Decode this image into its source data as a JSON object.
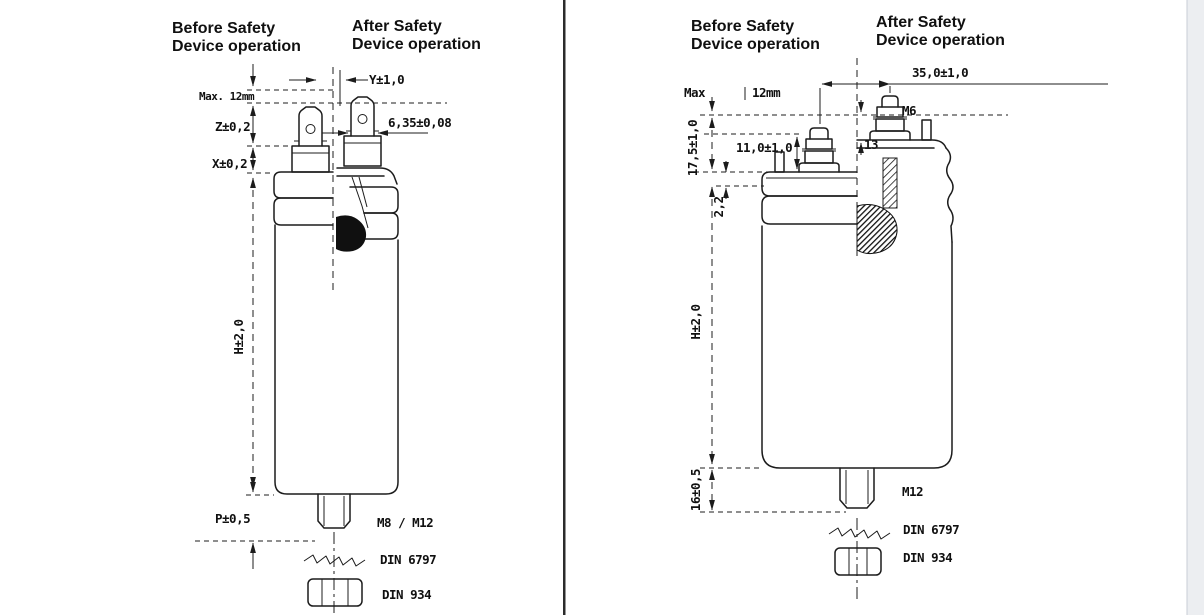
{
  "page": {
    "bg": "#ffffff",
    "divider_color": "#2b2b2b",
    "gutter_color": "#eceef1",
    "line_color": "#1c1c1c"
  },
  "left_panel": {
    "before_title_1": "Before Safety",
    "before_title_2": "Device operation",
    "after_title_1": "After Safety",
    "after_title_2": "Device operation",
    "dim_y": "Y±1,0",
    "dim_max": "Max. 12mm",
    "dim_z": "Z±0,2",
    "dim_tab": "6,35±0,08",
    "dim_x": "X±0,2",
    "dim_h": "H±2,0",
    "dim_p": "P±0,5",
    "thread": "M8 / M12",
    "washer": "DIN 6797",
    "nut": "DIN 934"
  },
  "right_panel": {
    "before_title_1": "Before Safety",
    "before_title_2": "Device operation",
    "after_title_1": "After Safety",
    "after_title_2": "Device operation",
    "dim_span": "35,0±1,0",
    "dim_max_word": "Max",
    "dim_max_val": "12mm",
    "dim_lid": "17,5±1,0",
    "dim_stud": "11,0±1,0",
    "dim_13": "13",
    "stud_thread": "M6",
    "dim_rim": "2,2",
    "dim_h": "H±2,0",
    "dim_bottom": "16±0,5",
    "thread": "M12",
    "washer": "DIN 6797",
    "nut": "DIN 934"
  }
}
